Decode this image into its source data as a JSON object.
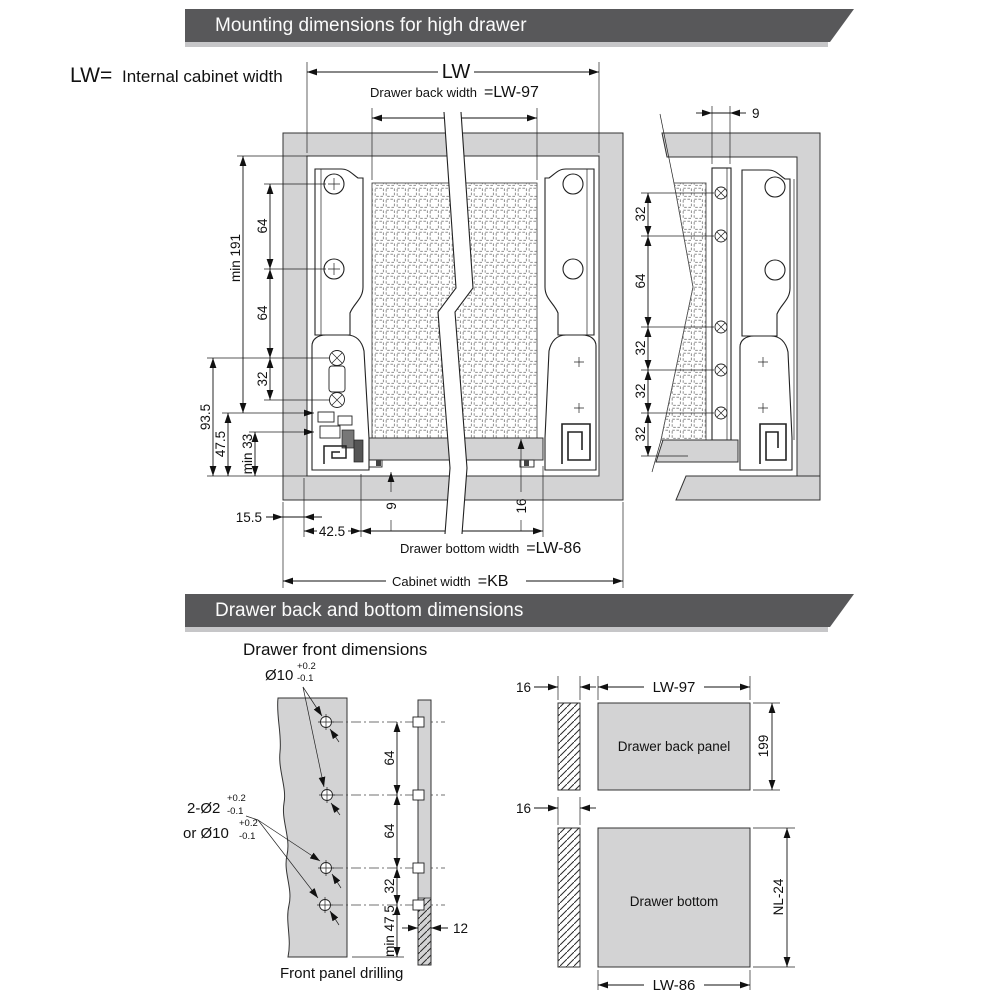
{
  "banner1": "Mounting dimensions for high drawer",
  "banner2": "Drawer back and bottom dimensions",
  "intro": {
    "symbol": "LW=",
    "text": "Internal cabinet width"
  },
  "front_view": {
    "lw": "LW",
    "back_width_label": "Drawer back width",
    "back_width_value": "=LW-97",
    "min191": "min 191",
    "d64a": "64",
    "d64b": "64",
    "d32": "32",
    "d935": "93.5",
    "d475": "47.5",
    "min33": "min 33",
    "d155": "15.5",
    "d425": "42.5",
    "d9": "9",
    "d16": "16",
    "bottom_width_label": "Drawer bottom width",
    "bottom_width_value": "=LW-86",
    "cabinet_width_label": "Cabinet width",
    "cabinet_width_value": "=KB"
  },
  "side_view": {
    "d9": "9",
    "chain": [
      "32",
      "64",
      "32",
      "32",
      "32"
    ]
  },
  "drilling": {
    "subtitle": "Drawer front dimensions",
    "ann1": {
      "text": "Ø10",
      "plus": "+0.2",
      "minus": "-0.1"
    },
    "ann2": {
      "text": "2-Ø2",
      "plus": "+0.2",
      "minus": "-0.1"
    },
    "ann3": {
      "text": "or Ø10",
      "plus": "+0.2",
      "minus": "-0.1"
    },
    "chain": [
      "64",
      "64",
      "32"
    ],
    "min475": "min 47.5",
    "d12": "12",
    "caption": "Front panel drilling"
  },
  "back_panel": {
    "d16": "16",
    "width": "LW-97",
    "label": "Drawer back panel",
    "height": "199"
  },
  "bottom_panel": {
    "d16": "16",
    "width": "LW-86",
    "label": "Drawer bottom",
    "height": "NL-24"
  },
  "colors": {
    "banner": "#58585a",
    "banner_shadow": "#c6c6c8",
    "panel": "#d3d3d4"
  }
}
